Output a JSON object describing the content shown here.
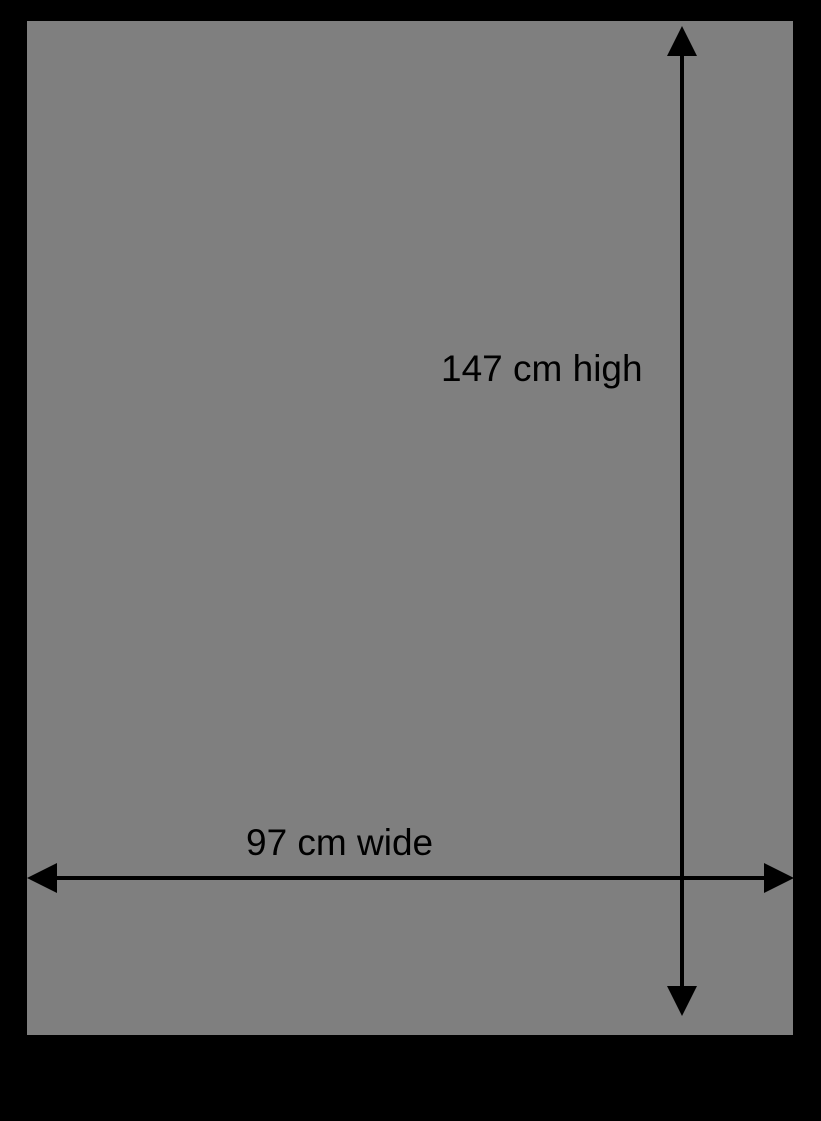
{
  "diagram": {
    "height_label": "147 cm high",
    "width_label": "97 cm wide"
  },
  "colors": {
    "background": "#000000",
    "panel": "#7f7f7f",
    "arrow": "#000000",
    "text": "#000000"
  }
}
